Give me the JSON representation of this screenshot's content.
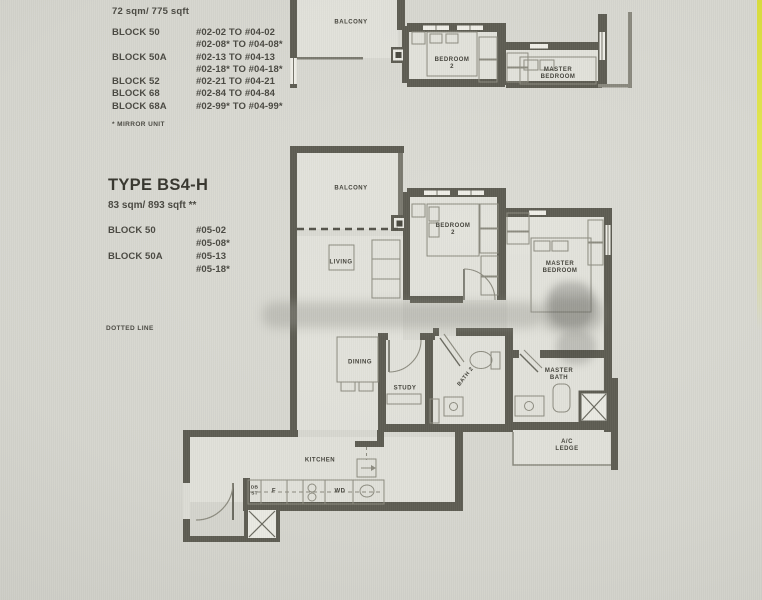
{
  "header": {
    "area": "72 sqm/ 775 sqft",
    "blocks": [
      {
        "label": "BLOCK 50",
        "units": [
          "#02-02 TO #04-02",
          "#02-08* TO #04-08*"
        ]
      },
      {
        "label": "BLOCK 50A",
        "units": [
          "#02-13 TO #04-13",
          "#02-18* TO #04-18*"
        ]
      },
      {
        "label": "BLOCK 52",
        "units": [
          "#02-21 TO #04-21"
        ]
      },
      {
        "label": "BLOCK 68",
        "units": [
          "#02-84 TO #04-84"
        ]
      },
      {
        "label": "BLOCK 68A",
        "units": [
          "#02-99* TO #04-99*"
        ]
      }
    ],
    "footnote": "* MIRROR UNIT"
  },
  "unit_type": {
    "title": "TYPE BS4-H",
    "area": "83 sqm/ 893 sqft **",
    "blocks": [
      {
        "label": "BLOCK 50",
        "units": [
          "#05-02",
          "#05-08*"
        ]
      },
      {
        "label": "BLOCK 50A",
        "units": [
          "#05-13",
          "#05-18*"
        ]
      }
    ],
    "legend": "DOTTED LINE"
  },
  "top_plan": {
    "balcony": "BALCONY",
    "bedroom2_line1": "BEDROOM",
    "bedroom2_line2": "2",
    "master_line1": "MASTER",
    "master_line2": "BEDROOM"
  },
  "main_plan": {
    "balcony": "BALCONY",
    "living": "LIVING",
    "bedroom2_line1": "BEDROOM",
    "bedroom2_line2": "2",
    "master_line1": "MASTER",
    "master_line2": "BEDROOM",
    "dining": "DINING",
    "study": "STUDY",
    "bath2": "BATH 2",
    "master_bath_line1": "MASTER",
    "master_bath_line2": "BATH",
    "kitchen": "KITCHEN",
    "ac_line1": "A/C",
    "ac_line2": "LEDGE",
    "fridge": "F",
    "washer": "WD",
    "db_line1": "DB",
    "db_line2": "ST"
  },
  "colors": {
    "wall": "#5e5d53",
    "paper": "#d5d5ce",
    "accent_yellow": "#dde04a"
  }
}
